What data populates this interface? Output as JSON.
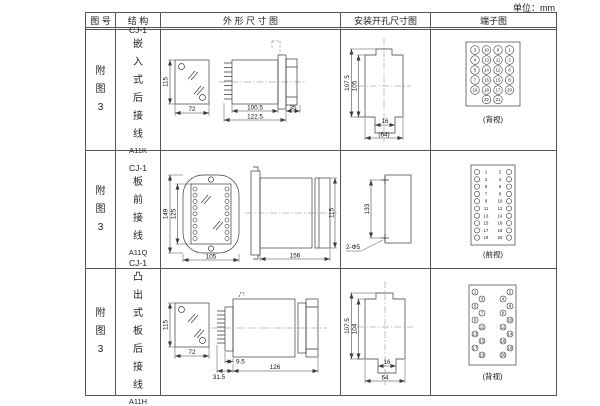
{
  "unit_label": "单位：mm",
  "header": {
    "fig_no": "图 号",
    "structure": "结 构",
    "outline": "外 形 尺 寸 图",
    "install": "安装开孔尺寸图",
    "terminal": "端子图"
  },
  "rows": [
    {
      "fig_no": "附图3",
      "model": "CJ-1",
      "structure": "嵌入式后接线",
      "code": "A11K",
      "outline": {
        "front_h": "115",
        "front_w": "72",
        "d1": "100.5",
        "d2": "122.5",
        "d3": "35"
      },
      "install": {
        "h1": "107.5",
        "h2": "105",
        "w1": "16",
        "w2": "(64)"
      },
      "terminal": {
        "view": "(背视)",
        "style": "grid",
        "grid": [
          [
            "3",
            "10",
            "9",
            "1"
          ],
          [
            "4",
            "13",
            "11",
            "2"
          ],
          [
            "5",
            "14",
            "12",
            "6"
          ],
          [
            "7",
            "16",
            "15",
            "8"
          ],
          [
            "19",
            "18",
            "17",
            "20"
          ]
        ],
        "bottom": [
          "22",
          "21"
        ]
      }
    },
    {
      "fig_no": "附图3",
      "model": "CJ-1",
      "structure": "板前接线",
      "code": "A11Q",
      "outline": {
        "front_h_outer": "149",
        "front_h_inner": "125",
        "front_w": "105",
        "depth": "156",
        "side_h": "115"
      },
      "install": {
        "spacing": "133",
        "holes": "2-Φ5"
      },
      "terminal": {
        "view": "(前视)",
        "style": "columns",
        "left": [
          "1",
          "3",
          "5",
          "7",
          "9",
          "11",
          "13",
          "15",
          "17",
          "19"
        ],
        "right": [
          "2",
          "4",
          "6",
          "8",
          "10",
          "12",
          "14",
          "16",
          "18",
          "20"
        ]
      }
    },
    {
      "fig_no": "附图3",
      "model": "CJ-1",
      "structure": "凸出式板后接线",
      "code": "A11H",
      "outline": {
        "front_h": "115",
        "front_w": "72",
        "d1": "9.5",
        "d2": "31.5",
        "d3": "126"
      },
      "install": {
        "h1": "107.5",
        "h2": "104",
        "w1": "16",
        "w2": "64"
      },
      "terminal": {
        "view": "(背视)",
        "style": "staggered",
        "left": [
          "1",
          "3",
          "5",
          "7",
          "9",
          "11",
          "13",
          "15",
          "17",
          "19"
        ],
        "right": [
          "2",
          "4",
          "6",
          "8",
          "10",
          "12",
          "14",
          "16",
          "18",
          "20"
        ]
      }
    }
  ]
}
